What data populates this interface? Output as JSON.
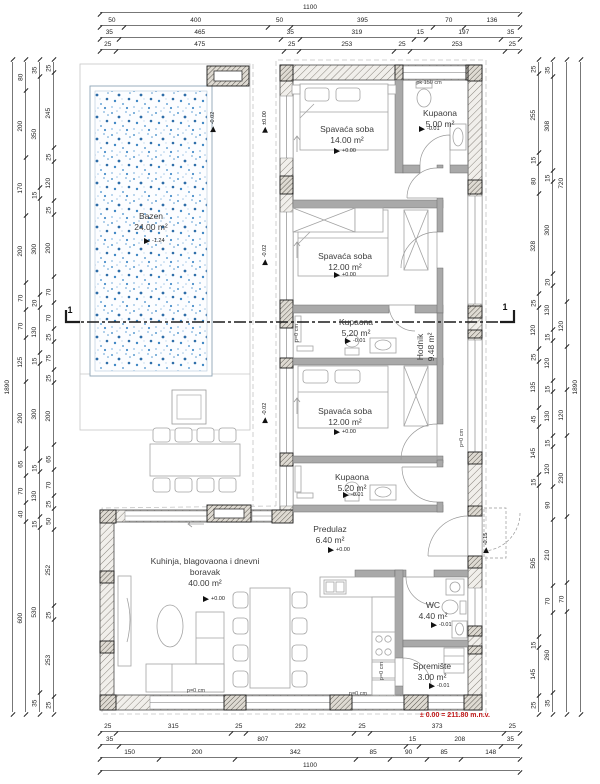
{
  "colors": {
    "red": "#c01818",
    "pool_dot": "#2e76b5",
    "hatch_line": "#8a857e",
    "wall_edge": "#4a4a4a"
  },
  "datum": {
    "v": "± 0.00 = 211.80 m.n.v."
  },
  "rooms": [
    {
      "name": "Bazen",
      "area": "24.00 m²",
      "x": 151,
      "y": 211,
      "w": 70
    },
    {
      "name": "Spavaća soba",
      "area": "14.00 m²",
      "x": 347,
      "y": 124,
      "w": 84
    },
    {
      "name": "Kupaona",
      "area": "5.00 m²",
      "x": 440,
      "y": 108,
      "w": 60
    },
    {
      "name": "Spavaća soba",
      "area": "12.00 m²",
      "x": 345,
      "y": 251,
      "w": 84
    },
    {
      "name": "Kupaona",
      "area": "5.20 m²",
      "x": 356,
      "y": 317,
      "w": 60
    },
    {
      "name": "Spavaća soba",
      "area": "12.00 m²",
      "x": 345,
      "y": 406,
      "w": 84
    },
    {
      "name": "Kupaona",
      "area": "5.20 m²",
      "x": 352,
      "y": 472,
      "w": 60
    },
    {
      "name": "Predulaz",
      "area": "6.40 m²",
      "x": 330,
      "y": 524,
      "w": 60
    },
    {
      "name": "WC",
      "area": "4.40 m²",
      "x": 433,
      "y": 600,
      "w": 50
    },
    {
      "name": "Spremište",
      "area": "3.00 m²",
      "x": 432,
      "y": 661,
      "w": 60
    },
    {
      "name": "Kuhinja, blagovaona i dnevni boravak",
      "area": "40.00 m²",
      "x": 205,
      "y": 556,
      "w": 122
    },
    {
      "name": "Hodnik",
      "area": "9.48 m²",
      "x": 456,
      "y": 347,
      "w": 60,
      "rot": true
    }
  ],
  "levels": [
    {
      "v": "-1.24",
      "x": 144,
      "y": 241
    },
    {
      "v": "+0.00",
      "x": 334,
      "y": 151
    },
    {
      "v": "-0.01",
      "x": 419,
      "y": 129
    },
    {
      "v": "+0.00",
      "x": 334,
      "y": 275
    },
    {
      "v": "-0.01",
      "x": 345,
      "y": 341
    },
    {
      "v": "+0.00",
      "x": 334,
      "y": 432
    },
    {
      "v": "-0.01",
      "x": 343,
      "y": 495
    },
    {
      "v": "+0.00",
      "x": 328,
      "y": 550
    },
    {
      "v": "-0.01",
      "x": 431,
      "y": 625
    },
    {
      "v": "-0.01",
      "x": 429,
      "y": 686
    },
    {
      "v": "+0.00",
      "x": 203,
      "y": 599
    },
    {
      "v": "-0.02",
      "x": 213,
      "y": 122,
      "rot": true
    },
    {
      "v": "±0.00",
      "x": 265,
      "y": 122,
      "rot": true
    },
    {
      "v": "-0.02",
      "x": 265,
      "y": 255,
      "rot": true
    },
    {
      "v": "-0.02",
      "x": 265,
      "y": 413,
      "rot": true
    },
    {
      "v": "-0.15",
      "x": 486,
      "y": 543,
      "rot": true
    }
  ],
  "notes": [
    {
      "v": "pk 150 cm",
      "x": 429,
      "y": 83
    },
    {
      "v": "p=0 cm",
      "x": 297,
      "y": 333,
      "rot": true
    },
    {
      "v": "p=0 cm",
      "x": 462,
      "y": 438,
      "rot": true
    },
    {
      "v": "p=0 cm",
      "x": 382,
      "y": 671,
      "rot": true
    },
    {
      "v": "p=0 cm",
      "x": 196,
      "y": 691
    },
    {
      "v": "p=0 cm",
      "x": 358,
      "y": 694
    },
    {
      "v": "1",
      "x": 70,
      "y": 310,
      "cls": "sec"
    },
    {
      "v": "1",
      "x": 505,
      "y": 307,
      "cls": "sec"
    }
  ],
  "dims": [
    {
      "d": "h",
      "x": 100,
      "y": 4,
      "len": 420,
      "segs": [
        [
          1100
        ]
      ]
    },
    {
      "d": "h",
      "x": 100,
      "y": 17,
      "len": 420,
      "segs": [
        [
          50
        ],
        [
          400
        ],
        [
          50
        ],
        [
          395
        ],
        [
          70
        ],
        [
          136
        ]
      ]
    },
    {
      "d": "h",
      "x": 100,
      "y": 29,
      "len": 420,
      "segs": [
        [
          35
        ],
        [
          465
        ],
        [
          35
        ],
        [
          319
        ],
        [
          15
        ],
        [
          197
        ],
        [
          35
        ]
      ]
    },
    {
      "d": "h",
      "x": 100,
      "y": 41,
      "len": 420,
      "segs": [
        [
          25
        ],
        [
          475
        ],
        [
          25
        ],
        [
          253
        ],
        [
          25
        ],
        [
          253
        ],
        [
          25
        ]
      ]
    },
    {
      "d": "h",
      "x": 100,
      "y": 723,
      "len": 420,
      "segs": [
        [
          25
        ],
        [
          315
        ],
        [
          25
        ],
        [
          292
        ],
        [
          25
        ],
        [
          373
        ],
        [
          25
        ]
      ]
    },
    {
      "d": "h",
      "x": 100,
      "y": 736,
      "len": 420,
      "segs": [
        [
          35
        ],
        [
          807
        ],
        [
          15
        ],
        [
          208
        ],
        [
          35
        ]
      ]
    },
    {
      "d": "h",
      "x": 100,
      "y": 749,
      "len": 420,
      "segs": [
        [
          150
        ],
        [
          200
        ],
        [
          342
        ],
        [
          85
        ],
        [
          90
        ],
        [
          85
        ],
        [
          148
        ]
      ]
    },
    {
      "d": "h",
      "x": 100,
      "y": 762,
      "len": 420,
      "segs": [
        [
          1100
        ]
      ]
    },
    {
      "d": "v",
      "x": 6,
      "y": 62,
      "len": 650,
      "segs": [
        [
          1890
        ]
      ]
    },
    {
      "d": "v",
      "x": 19,
      "y": 62,
      "len": 650,
      "segs": [
        [
          80
        ],
        [
          200
        ],
        [
          170
        ],
        [
          200
        ],
        [
          70
        ],
        [
          70
        ],
        [
          125
        ],
        [
          200
        ],
        [
          65
        ],
        [
          70
        ],
        [
          40
        ],
        [
          600
        ]
      ]
    },
    {
      "d": "v",
      "x": 33,
      "y": 62,
      "len": 650,
      "segs": [
        [
          35
        ],
        [
          350
        ],
        [
          15
        ],
        [
          300
        ],
        [
          20
        ],
        [
          130
        ],
        [
          15
        ],
        [
          300
        ],
        [
          15
        ],
        [
          130
        ],
        [
          15
        ],
        [
          530
        ],
        [
          35
        ]
      ]
    },
    {
      "d": "v",
      "x": 47,
      "y": 62,
      "len": 650,
      "segs": [
        [
          25
        ],
        [
          245
        ],
        [
          25
        ],
        [
          120
        ],
        [
          25
        ],
        [
          200
        ],
        [
          70
        ],
        [
          70
        ],
        [
          25
        ],
        [
          75
        ],
        [
          25
        ],
        [
          200
        ],
        [
          65
        ],
        [
          70
        ],
        [
          25
        ],
        [
          50
        ],
        [
          252
        ],
        [
          25
        ],
        [
          253
        ],
        [
          25
        ]
      ]
    },
    {
      "d": "v",
      "x": 532,
      "y": 62,
      "len": 650,
      "segs": [
        [
          25
        ],
        [
          255
        ],
        [
          15
        ],
        [
          80
        ],
        [
          328
        ],
        [
          25
        ],
        [
          120
        ],
        [
          25
        ],
        [
          135
        ],
        [
          45
        ],
        [
          145
        ],
        [
          15
        ],
        [
          505
        ],
        [
          15
        ],
        [
          145
        ],
        [
          25
        ]
      ]
    },
    {
      "d": "v",
      "x": 546,
      "y": 62,
      "len": 650,
      "segs": [
        [
          35
        ],
        [
          308
        ],
        [
          15
        ],
        [
          300
        ],
        [
          20
        ],
        [
          130
        ],
        [
          15
        ],
        [
          120
        ],
        [
          15
        ],
        [
          130
        ],
        [
          15
        ],
        [
          120
        ],
        [
          90
        ],
        [
          210
        ],
        [
          70
        ],
        [
          260
        ],
        [
          35
        ]
      ]
    },
    {
      "d": "v",
      "x": 560,
      "y": 62,
      "len": 650,
      "segs": [
        [
          720
        ],
        [
          120
        ],
        [
          "",
          130
        ],
        [
          120
        ],
        [
          230
        ],
        [
          "",
          200
        ],
        [
          70
        ],
        [
          "",
          300
        ]
      ]
    },
    {
      "d": "v",
      "x": 574,
      "y": 62,
      "len": 650,
      "segs": [
        [
          1890
        ]
      ]
    }
  ]
}
